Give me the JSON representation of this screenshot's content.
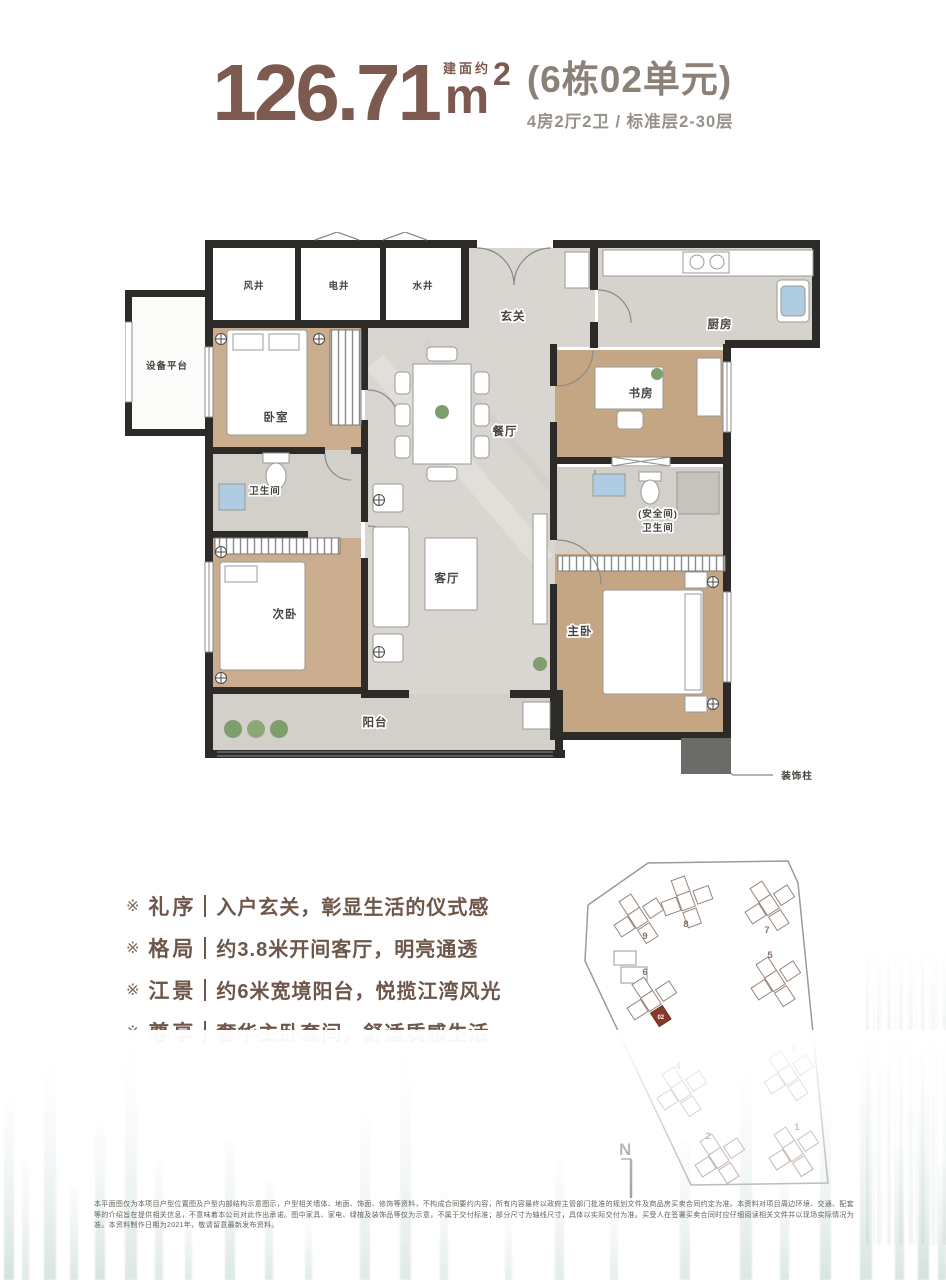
{
  "header": {
    "area_prefix": "建面约",
    "area_value": "126.71",
    "area_unit": "m",
    "area_sup": "2",
    "unit_name": "(6栋02单元)",
    "spec": "4房2厅2卫 / 标准层2-30层"
  },
  "plan": {
    "rooms": {
      "wind_shaft": "风井",
      "elec_shaft": "电井",
      "water_shaft": "水井",
      "foyer": "玄关",
      "kitchen": "厨房",
      "equipment_platform": "设备平台",
      "bedroom": "卧室",
      "dining": "餐厅",
      "study": "书房",
      "bath": "卫生间",
      "living": "客厅",
      "second_bedroom": "次卧",
      "safe_room": "(安全间)",
      "safe_bath": "卫生间",
      "master_bedroom": "主卧",
      "balcony": "阳台",
      "decor_column": "装饰柱"
    }
  },
  "features": {
    "bullet": "※",
    "items": [
      {
        "tag": "礼序",
        "desc": "入户玄关，彰显生活的仪式感"
      },
      {
        "tag": "格局",
        "desc": "约3.8米开间客厅，明亮通透"
      },
      {
        "tag": "江景",
        "desc": "约6米宽境阳台，悦揽江湾风光"
      },
      {
        "tag": "尊享",
        "desc": "奢华主卧套间，舒适质感生活"
      }
    ]
  },
  "siteplan": {
    "compass": "N",
    "highlight_unit": "02",
    "buildings": [
      {
        "no": "9"
      },
      {
        "no": "8"
      },
      {
        "no": "7"
      },
      {
        "no": "5"
      },
      {
        "no": "6"
      },
      {
        "no": "4"
      },
      {
        "no": "3"
      },
      {
        "no": "2"
      },
      {
        "no": "1"
      }
    ]
  },
  "disclaimer": "本平面图仅为本项目户型位置图及户型内部结构示意图示，户型相关墙体、地面、饰面、修饰等资料，不构成合同要约内容，所有内容最终以政府主管部门批准的规划文件及商品房买卖合同约定为准。本资料对项目周边环境、交通、配套等的介绍旨在提供相关信息，不意味着本公司对此作出承诺。图中家具、家电、绿植及装饰品等仅为示意，不属于交付标准；部分尺寸为轴线尺寸，具体以实际交付为准。买受人在签署买卖合同时应仔细阅读相关文件并以现场实际情况为准。本资料制作日期为2021年，敬请留意最新发布资料。",
  "colors": {
    "title_brown": "#7d5a50",
    "unit_gray_brown": "#8b8177",
    "subtitle_gray": "#96918a",
    "feature_brown": "#6e574a",
    "wall_black": "#2d2b28",
    "wood_floor": "#c9ad8e",
    "marble_floor": "#d9d5d0",
    "highlight_red": "#8b3a2a",
    "forest_green": "#8fb8a3"
  }
}
